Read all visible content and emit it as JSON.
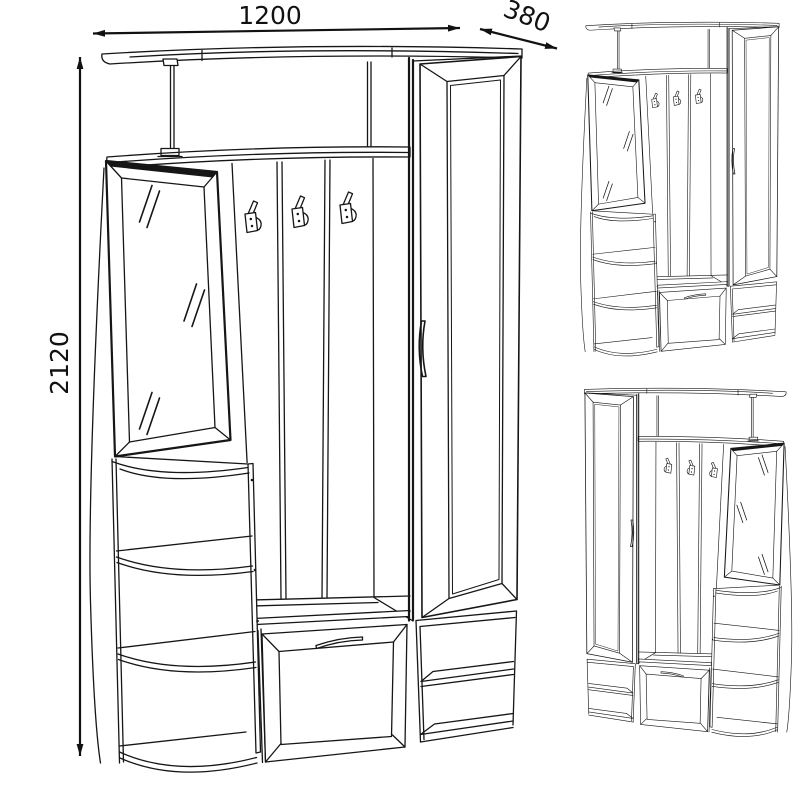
{
  "drawing": {
    "background": "#ffffff",
    "line_color": "#161616",
    "views": {
      "main": "front-perspective-with-dimensions",
      "top_right": "variant-mirror-left",
      "bottom_right": "variant-mirror-right"
    }
  },
  "dimensions": {
    "width": "1200",
    "depth": "380",
    "height": "2120"
  }
}
